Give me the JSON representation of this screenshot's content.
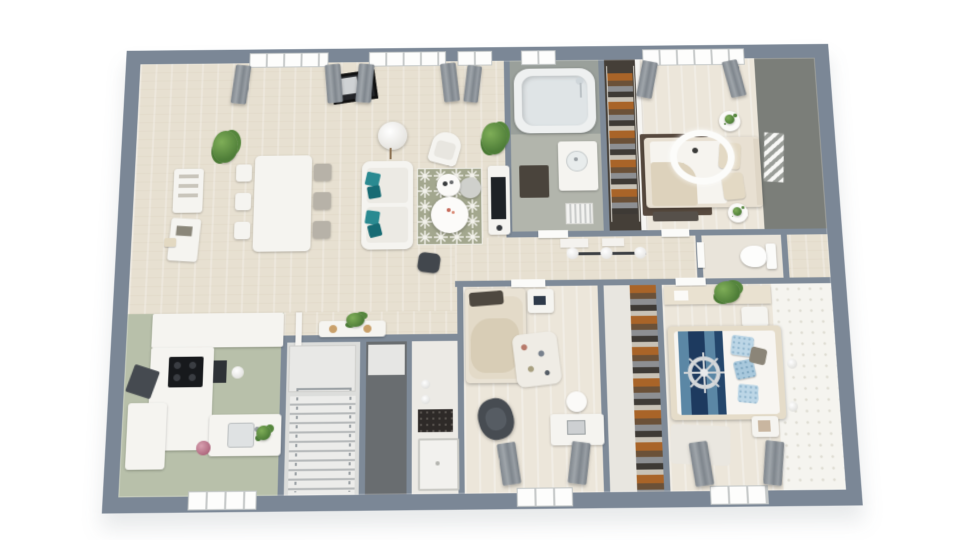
{
  "scene": {
    "type": "3d-floor-plan-render",
    "view": "top-down dollhouse perspective of a single-storey home",
    "background": "#ffffff",
    "visible_text": ""
  },
  "palette": {
    "background": "#ffffff",
    "wall-exterior": "#7b8796",
    "wall-interior": "#7e8a98",
    "floor-wood": "#e7e0d1",
    "floor-wood-light": "#ece6da",
    "floor-kitchen": "#b8c0aa",
    "bath-wall": "#9aa09b",
    "bath-floor": "#b2b5ac",
    "accent-wall": "#7b7e79",
    "wallpaper": "#f5f4ef",
    "rug-olive": "#a3a78e",
    "rug-dark": "#57493e",
    "furniture-white": "#f5f4f0",
    "pillow-teal": "#2a8a91",
    "pillow-teal-dark": "#176b74",
    "curtain-gray": "#8b9198",
    "bed-navy": "#1d3a5f",
    "bed-steel-blue": "#5b87a5",
    "pillow-light-blue": "#bcd6e6",
    "bedding-beige": "#ddd2bc",
    "bedding-dark-pillow": "#4e4840",
    "dark-furniture": "#42474d",
    "plant-green": "#4e7d38",
    "closet-dark": "#453f38",
    "clothes-orange": "#a96428",
    "stair-tread": "#b6b9ba",
    "mosaic-dark": "#2e2a28"
  },
  "rooms": {
    "living": {
      "name": "living-dining-room",
      "furniture": [
        "dining-table",
        "six-chairs",
        "wall-shelves",
        "sofa",
        "teal-pillows",
        "patterned-rug",
        "coffee-tables",
        "armchair",
        "floor-lamp",
        "tv-console",
        "pouf",
        "plants",
        "windows-with-curtains",
        "wall-picture"
      ]
    },
    "kitchen": {
      "name": "kitchen",
      "furniture": [
        "l-shaped-counter",
        "cooktop",
        "extractor-hood",
        "oven",
        "sink",
        "fridge",
        "ball-lamp",
        "window",
        "flowers"
      ]
    },
    "bathroom": {
      "name": "bathroom",
      "furniture": [
        "bathtub",
        "shower-fixture",
        "vanity-sink",
        "dark-mat",
        "radiator",
        "window"
      ]
    },
    "dressing": {
      "name": "wardrobe-closet",
      "furniture": [
        "hanging-clothes",
        "sliding-door"
      ]
    },
    "bedroom1": {
      "name": "bedroom-1",
      "furniture": [
        "double-bed",
        "dark-rug",
        "ceiling-ring-light",
        "round-nightstands",
        "bench",
        "accent-wall-art",
        "window-with-curtains"
      ]
    },
    "hallway": {
      "name": "hallway",
      "furniture": [
        "three-globe-pendant",
        "floor-panels"
      ]
    },
    "wc": {
      "name": "wc",
      "furniture": [
        "toilet"
      ]
    },
    "bedroom2": {
      "name": "bedroom-2",
      "furniture": [
        "single-bed",
        "dark-pillow",
        "bedside-table",
        "clutter-rug",
        "dark-armchair",
        "desk",
        "desk-chair",
        "window-with-curtains"
      ]
    },
    "closet2": {
      "name": "shoe-closet",
      "furniture": [
        "shelving",
        "sliding-door"
      ]
    },
    "bedroom3": {
      "name": "bedroom-3",
      "furniture": [
        "double-bed-nautical",
        "ship-wheel-decor",
        "blue-pillows",
        "headboard-console",
        "plants",
        "nightstands",
        "patterned-wallpaper-wall",
        "wall-lamps",
        "window-with-curtains",
        "light-rug"
      ]
    },
    "stairs": {
      "name": "staircase",
      "furniture": [
        "steps",
        "railings",
        "landing"
      ]
    },
    "corridor": {
      "name": "entry-corridor",
      "furniture": [
        "white-door"
      ]
    },
    "shower": {
      "name": "shower-room",
      "furniture": [
        "shower-tray",
        "dark-mosaic-panel",
        "globe-wall-lights"
      ]
    },
    "console_zone": {
      "name": "console-wall",
      "furniture": [
        "console-table",
        "plant"
      ]
    }
  }
}
